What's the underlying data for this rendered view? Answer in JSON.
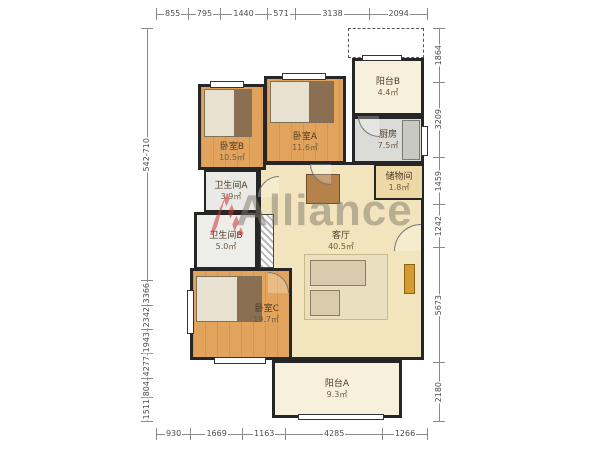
{
  "watermark": {
    "text": "Alliance"
  },
  "rooms": [
    {
      "id": "bedroom-b",
      "name": "卧室B",
      "area": "10.5㎡"
    },
    {
      "id": "bedroom-a",
      "name": "卧室A",
      "area": "11.6㎡"
    },
    {
      "id": "balcony-b",
      "name": "阳台B",
      "area": "4.4㎡"
    },
    {
      "id": "kitchen",
      "name": "厨房",
      "area": "7.5㎡"
    },
    {
      "id": "storage",
      "name": "储物间",
      "area": "1.8㎡"
    },
    {
      "id": "bathroom-a",
      "name": "卫生间A",
      "area": "3.9㎡"
    },
    {
      "id": "bathroom-b",
      "name": "卫生间B",
      "area": "5.0㎡"
    },
    {
      "id": "living",
      "name": "客厅",
      "area": "40.5㎡"
    },
    {
      "id": "bedroom-c",
      "name": "卧室C",
      "area": "19.7㎡"
    },
    {
      "id": "balcony-a",
      "name": "阳台A",
      "area": "9.3㎡"
    }
  ],
  "dimensions": {
    "top": [
      "855",
      "795",
      "1440",
      "571",
      "3138",
      "2094"
    ],
    "bottom": [
      "930",
      "1669",
      "1163",
      "4285",
      "1266"
    ],
    "left": [
      "542-710",
      "3366",
      "2342",
      "1943",
      "4277",
      "804",
      "1511"
    ],
    "right": [
      "1864",
      "3209",
      "1459",
      "1242",
      "5673",
      "2180"
    ]
  },
  "colors": {
    "wall": "#262626",
    "wood_floor": "#e2a45c",
    "living_floor": "#f2e4bc",
    "balcony_floor": "#f7f0da",
    "tile_floor": "#dbdbd7",
    "watermark_red": "#cc3333",
    "watermark_gray": "#7d776c"
  }
}
